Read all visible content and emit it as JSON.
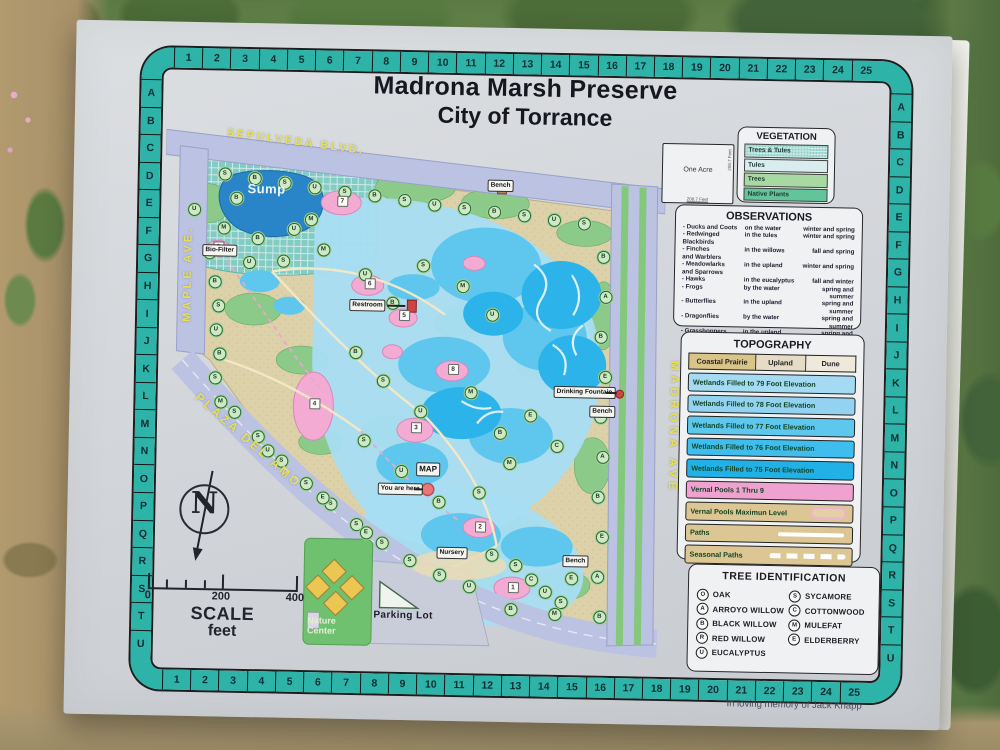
{
  "sign": {
    "title_line1": "Madrona Marsh Preserve",
    "title_line2": "City of Torrance",
    "memorial": "In loving memory of Jack Knapp"
  },
  "grid": {
    "numbers": [
      "1",
      "2",
      "3",
      "4",
      "5",
      "6",
      "7",
      "8",
      "9",
      "10",
      "11",
      "12",
      "13",
      "14",
      "15",
      "16",
      "17",
      "18",
      "19",
      "20",
      "21",
      "22",
      "23",
      "24",
      "25"
    ],
    "letters": "ABCDEFGHIJKLMNOPQRSTU"
  },
  "one_acre": {
    "label": "One Acre",
    "side": "208.7 Feet",
    "bottom": "208.7 Feet"
  },
  "vegetation": {
    "title": "VEGETATION",
    "rows": [
      {
        "label": "Trees & Tules",
        "cls": "sw-tt"
      },
      {
        "label": "Tules",
        "cls": "sw-tules"
      },
      {
        "label": "Trees",
        "cls": "sw-trees"
      },
      {
        "label": "Native Plants",
        "cls": "sw-native"
      }
    ]
  },
  "observations": {
    "title": "OBSERVATIONS",
    "rows": [
      {
        "who": "- Ducks and Coots",
        "where": "on the water",
        "when": "winter and spring"
      },
      {
        "who": "- Redwinged\n  Blackbirds",
        "where": "in the tules",
        "when": "winter and spring"
      },
      {
        "who": "- Finches\n  and Warblers",
        "where": "in the willows",
        "when": "fall and spring"
      },
      {
        "who": "- Meadowlarks\n  and Sparrows",
        "where": "in the upland",
        "when": "winter and spring"
      },
      {
        "who": "- Hawks",
        "where": "in the eucalyptus",
        "when": "fall and winter"
      },
      {
        "who": "- Frogs",
        "where": "by the water",
        "when": "spring and summer"
      },
      {
        "who": "- Butterflies",
        "where": "in the upland",
        "when": "spring and summer"
      },
      {
        "who": "- Dragonflies",
        "where": "by the water",
        "when": "spring and summer"
      },
      {
        "who": "- Grasshoppers",
        "where": "in the upland",
        "when": "spring and summer"
      }
    ]
  },
  "topography": {
    "title": "TOPOGRAPHY",
    "header": [
      "Coastal Prairie",
      "Upland",
      "Dune"
    ],
    "rows": [
      {
        "label": "Wetlands Filled to 79 Foot Elevation",
        "cls": "t79"
      },
      {
        "label": "Wetlands Filled to 78 Foot Elevation",
        "cls": "t78"
      },
      {
        "label": "Wetlands Filled to 77 Foot Elevation",
        "cls": "t77"
      },
      {
        "label": "Wetlands Filled to 76 Foot Elevation",
        "cls": "t76"
      },
      {
        "label": "Wetlands Filled to 75 Foot Elevation",
        "cls": "t75"
      },
      {
        "label": "Vernal Pools   1 Thru 9",
        "cls": "tpink"
      },
      {
        "label": "Vernal Pools  Maximun Level",
        "cls": "ttan",
        "extra": "oval"
      },
      {
        "label": "Paths",
        "cls": "ttan",
        "extra": "line"
      },
      {
        "label": "Seasonal Paths",
        "cls": "ttan",
        "extra": "dash"
      }
    ]
  },
  "tree_id": {
    "title": "TREE  IDENTIFICATION",
    "left": [
      {
        "sym": "O",
        "name": "OAK"
      },
      {
        "sym": "A",
        "name": "ARROYO WILLOW"
      },
      {
        "sym": "B",
        "name": "BLACK WILLOW"
      },
      {
        "sym": "R",
        "name": "RED WILLOW"
      },
      {
        "sym": "U",
        "name": "EUCALYPTUS"
      }
    ],
    "right": [
      {
        "sym": "S",
        "name": "SYCAMORE"
      },
      {
        "sym": "C",
        "name": "COTTONWOOD"
      },
      {
        "sym": "M",
        "name": "MULEFAT"
      },
      {
        "sym": "E",
        "name": "ELDERBERRY"
      }
    ]
  },
  "scale": {
    "n0": "0",
    "n200": "200",
    "n400": "400",
    "word": "SCALE",
    "unit": "feet",
    "compass_n": "N"
  },
  "map": {
    "streets": {
      "sepulveda": "SEPULVEDA  BLVD.",
      "maple": "MAPLE  AVE.",
      "plaza": "PLAZA DEL AMO",
      "madrona": "MADRONA  AVE"
    },
    "labels": {
      "sump": "Sump",
      "biofilter": "Bio-Filter",
      "restroom": "Restroom",
      "drinking": "Drinking Fountain",
      "bench": "Bench",
      "mapbox": "MAP",
      "youarehere": "You are here",
      "nursery": "Nursery",
      "parking": "Parking Lot",
      "naturecenter_1": "Nature",
      "naturecenter_2": "Center"
    },
    "pools": [
      {
        "n": "1",
        "x": 354,
        "y": 472
      },
      {
        "n": "2",
        "x": 320,
        "y": 412
      },
      {
        "n": "3",
        "x": 254,
        "y": 314
      },
      {
        "n": "4",
        "x": 152,
        "y": 292
      },
      {
        "n": "5",
        "x": 240,
        "y": 202
      },
      {
        "n": "6",
        "x": 205,
        "y": 171
      },
      {
        "n": "7",
        "x": 176,
        "y": 89
      },
      {
        "n": "8",
        "x": 290,
        "y": 255
      },
      {
        "n": "9",
        "x": 53,
        "y": 137
      }
    ],
    "benches": [
      [
        322,
        66
      ],
      [
        428,
        290
      ],
      [
        404,
        440
      ]
    ],
    "trees": [
      [
        "S",
        58,
        64
      ],
      [
        "B",
        88,
        68
      ],
      [
        "S",
        118,
        72
      ],
      [
        "U",
        148,
        76
      ],
      [
        "S",
        178,
        80
      ],
      [
        "B",
        208,
        83
      ],
      [
        "S",
        238,
        87
      ],
      [
        "U",
        268,
        91
      ],
      [
        "S",
        298,
        94
      ],
      [
        "B",
        328,
        97
      ],
      [
        "S",
        358,
        100
      ],
      [
        "U",
        388,
        104
      ],
      [
        "S",
        418,
        107
      ],
      [
        "U",
        28,
        100
      ],
      [
        "M",
        58,
        118
      ],
      [
        "B",
        92,
        128
      ],
      [
        "U",
        128,
        118
      ],
      [
        "M",
        158,
        138
      ],
      [
        "B",
        44,
        143
      ],
      [
        "U",
        84,
        152
      ],
      [
        "S",
        118,
        150
      ],
      [
        "M",
        145,
        108
      ],
      [
        "B",
        70,
        88
      ],
      [
        "B",
        50,
        172
      ],
      [
        "S",
        54,
        196
      ],
      [
        "U",
        52,
        220
      ],
      [
        "B",
        56,
        244
      ],
      [
        "S",
        52,
        268
      ],
      [
        "M",
        58,
        292
      ],
      [
        "U",
        200,
        162
      ],
      [
        "B",
        228,
        190
      ],
      [
        "S",
        258,
        152
      ],
      [
        "M",
        298,
        172
      ],
      [
        "U",
        328,
        200
      ],
      [
        "B",
        192,
        240
      ],
      [
        "S",
        220,
        268
      ],
      [
        "U",
        258,
        298
      ],
      [
        "M",
        308,
        278
      ],
      [
        "B",
        338,
        318
      ],
      [
        "S",
        202,
        328
      ],
      [
        "U",
        240,
        358
      ],
      [
        "B",
        278,
        388
      ],
      [
        "S",
        318,
        378
      ],
      [
        "M",
        348,
        348
      ],
      [
        "E",
        368,
        300
      ],
      [
        "C",
        395,
        330
      ],
      [
        "S",
        72,
        302
      ],
      [
        "S",
        96,
        326
      ],
      [
        "S",
        120,
        350
      ],
      [
        "S",
        145,
        372
      ],
      [
        "S",
        170,
        392
      ],
      [
        "S",
        196,
        412
      ],
      [
        "S",
        222,
        430
      ],
      [
        "S",
        250,
        447
      ],
      [
        "S",
        280,
        461
      ],
      [
        "U",
        106,
        340
      ],
      [
        "E",
        162,
        386
      ],
      [
        "E",
        206,
        420
      ],
      [
        "U",
        310,
        472
      ],
      [
        "S",
        332,
        440
      ],
      [
        "S",
        356,
        450
      ],
      [
        "C",
        372,
        464
      ],
      [
        "U",
        386,
        476
      ],
      [
        "S",
        402,
        486
      ],
      [
        "B",
        352,
        494
      ],
      [
        "M",
        396,
        498
      ],
      [
        "E",
        412,
        462
      ],
      [
        "B",
        438,
        140
      ],
      [
        "A",
        441,
        180
      ],
      [
        "B",
        437,
        220
      ],
      [
        "E",
        442,
        260
      ],
      [
        "B",
        438,
        300
      ],
      [
        "A",
        441,
        340
      ],
      [
        "B",
        437,
        380
      ],
      [
        "E",
        442,
        420
      ],
      [
        "A",
        438,
        460
      ],
      [
        "B",
        441,
        500
      ]
    ]
  },
  "colors": {
    "grid_teal": "#2eb3a9",
    "road_lavender": "#bcc2e2",
    "street_label_yellow": "#e6e153",
    "sump_blue": "#2a85c8",
    "wetland_light": "#a8ddf3",
    "wetland_deep": "#2cb3e9",
    "vernal_pink": "#f3abd4",
    "prairie_tan": "#dcd1a9",
    "tree_green": "#8cca8a"
  }
}
